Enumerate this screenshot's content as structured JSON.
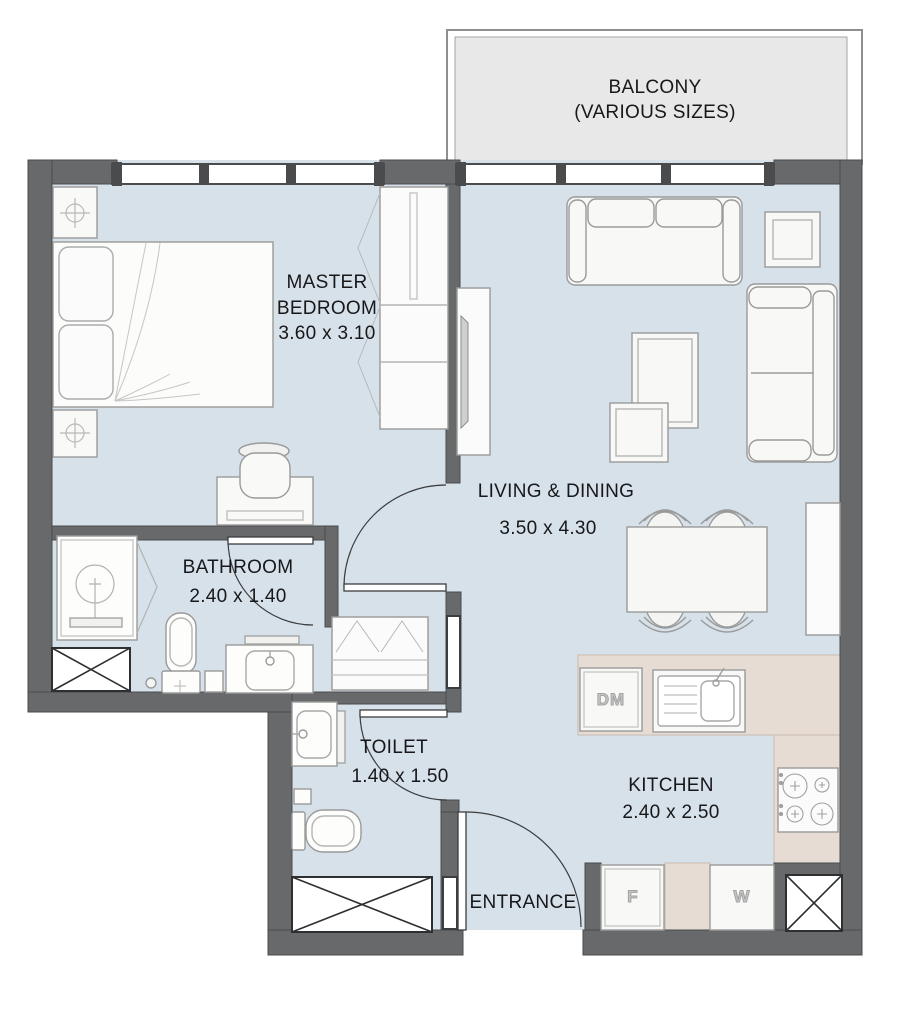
{
  "title": "Apartment floor plan",
  "colors": {
    "wall": "#67696b",
    "floor": "#d6e1e9",
    "balcony": "#e8e8e8",
    "counter": "#e7dcd4",
    "furniture_line": "#9a9a9a",
    "text": "#18181a"
  },
  "rooms": {
    "balcony": {
      "name": "BALCONY",
      "note": "(VARIOUS SIZES)"
    },
    "master_bedroom": {
      "name": "MASTER BEDROOM",
      "dims": "3.60 x 3.10"
    },
    "living_dining": {
      "name": "LIVING & DINING",
      "dims": "3.50 x 4.30"
    },
    "bathroom": {
      "name": "BATHROOM",
      "dims": "2.40 x 1.40"
    },
    "toilet": {
      "name": "TOILET",
      "dims": "1.40 x 1.50"
    },
    "kitchen": {
      "name": "KITCHEN",
      "dims": "2.40 x 2.50"
    },
    "entrance": {
      "name": "ENTRANCE"
    }
  },
  "appliances": {
    "dishwasher": "DM",
    "fridge": "F",
    "washer": "W"
  }
}
